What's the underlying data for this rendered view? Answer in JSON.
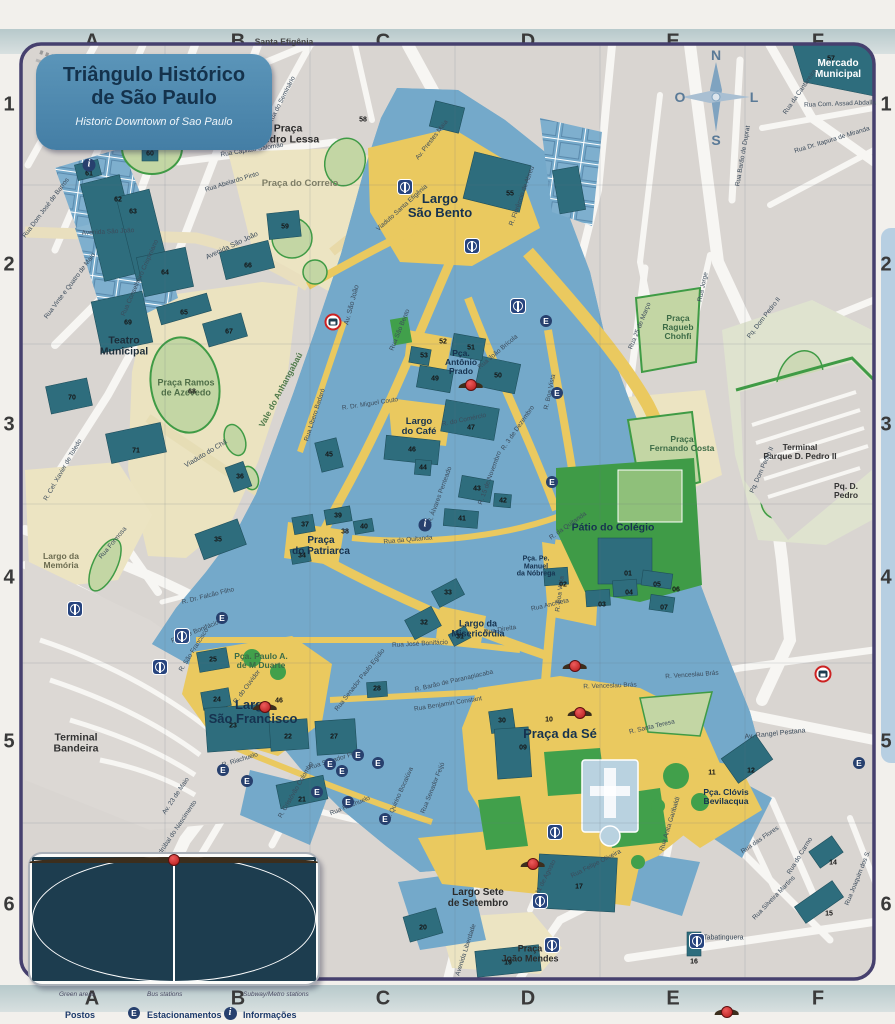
{
  "title": {
    "line1": "Triângulo Histórico",
    "line2": "de São Paulo",
    "subtitle": "Historic Downtown of Sao Paulo"
  },
  "grid": {
    "cols": [
      "A",
      "B",
      "C",
      "D",
      "E",
      "F"
    ],
    "rows": [
      "1",
      "2",
      "3",
      "4",
      "5",
      "6"
    ]
  },
  "compass": {
    "n": "N",
    "s": "S",
    "l": "L",
    "o": "O"
  },
  "legend": {
    "title": "Legenda",
    "items": [
      {
        "label": "Triângulo\nHistórico",
        "sub": "Historic Downtown"
      },
      {
        "label": "Edifícios\nHistóricos",
        "sub": "Historic Sites"
      },
      {
        "label": "Calçadas e\nÁreas de pedestres",
        "sub": "Pedestrian areas"
      },
      {
        "label": "Praças e\ncanteiros",
        "sub": "Green areas"
      },
      {
        "label": "Terminais\nde Ônibus",
        "sub": "Bus stations"
      },
      {
        "label": "Acessos ao Metrô",
        "sub": "Subway/Metro stations"
      },
      {
        "label": "Postos\nPoliciais",
        "sub": "Police"
      },
      {
        "label": "Estacionamentos\nprivativos",
        "sub": "Private parkinglot"
      },
      {
        "label": "Informações\nTurísticas",
        "sub": "Touristic Information"
      }
    ]
  },
  "colors": {
    "triangle": "#6fa8cc",
    "historic": "#2e6d7d",
    "pedestrian": "#eac95f",
    "green": "#3da045"
  },
  "icons": {
    "parking_glyph": "E",
    "info_glyph": "i"
  },
  "places": {
    "largo_sao_bento": "Largo\nSão Bento",
    "praca_da_se": "Praça da Sé",
    "largo_sao_francisco": "Largo\nSão Francisco",
    "patio_do_colegio": "Pátio do Colégio",
    "teatro_municipal": "Teatro\nMunicipal",
    "terminal_bandeira": "Terminal\nBandeira",
    "terminal_parque": "Terminal\nParque D. Pedro II",
    "pq_d_pedro": "Pq. D. Pedro",
    "mercado_municipal": "Mercado\nMunicipal",
    "praca_pedro_lessa": "Praça\nPedro Lessa",
    "praca_do_correio": "Praça do Correio",
    "santa_efigenia": "Santa Efigênia",
    "largo_do_paissandu": "Largo\ndo Paissandu",
    "praca_ramos": "Praça Ramos\nde Azevedo",
    "praca_fernando_costa": "Praça\nFernando Costa",
    "praca_ragueb": "Praça\nRagueb\nChohfi",
    "pca_clovis": "Pça. Clóvis\nBevilacqua",
    "largo_sete": "Largo Sete\nde Setembro",
    "praca_joao_mendes": "Praça\nJoão Mendes",
    "largo_da_memoria": "Largo da\nMemória",
    "largo_misericordia": "Largo da\nMisericórdia",
    "largo_do_cafe": "Largo\ndo Café",
    "pca_antonio_prado": "Pça.\nAntônio\nPrado",
    "praca_do_patriarca": "Praça\ndo Patriarca",
    "pca_paulo_duarte": "Pça. Paulo A.\nde M Duarte",
    "vale_anhangabau": "Vale do Anhangabaú",
    "pca_manuel": "Pça. Pe.\nManuel\nda Nóbrega"
  },
  "streets": {
    "av_sao_joao": "Av. São João",
    "avenida_sao_joao": "Avenida São João",
    "avenida_sao_joao2": "Avenida São João",
    "libero_badaro": "Rua Líbero Badaró",
    "sao_bento": "Rua São Bento",
    "falcao_filho": "R. Dr. Falcão Filho",
    "jose_bonifacio": "R. José Bonifácio",
    "jose_bonifacio2": "Rua José Bonifácio",
    "benjamin": "Rua Benjamin Constant",
    "senador_feijo": "Rua Senador Feijó",
    "senador_feijo2": "Rua Senador Feijó",
    "riachuelo": "R. Riachuelo",
    "riachuelo2": "Rua Riachuelo",
    "direita": "Rua Direita",
    "quitanda": "Rua da Quitanda",
    "quitanda2": "R. da Quitanda",
    "comercio": "R. do Comércio",
    "tres_dezembro": "R. 3 de Dezembro",
    "quinze_novembro": "R. 15 de Novembro",
    "alvares_penteado": "R. Álvares Penteado",
    "boa_vista": "R. Boa Vista",
    "boa_vista2": "R. Boa Vista",
    "florencio": "R. Florêncio de Abreu",
    "prestes_maia": "Av. Prestes Maia",
    "viaduto_sta_efigenia": "Viaduto Santa Efigênia",
    "capitao_salomao": "Rua Capitão Salomão",
    "seminario": "Rua do Seminário",
    "vinte_cinco_marco": "Rua 25 de Março",
    "jorge": "Rua Jorge",
    "pq_dom_pedro": "Pq. Dom Pedro II",
    "pq_dom_pedro2": "Pq. Dom Pedro II",
    "assad_abdalla": "Rua Com. Assad Abdalla",
    "cantareira": "Rua da Cantareira",
    "barao_duprat": "Rua Barão de Duprat",
    "itapura": "Rua Dr. Itapura de Miranda",
    "rangel_pestana": "Av. Rangel Pestana",
    "venceslau": "R. Venceslau Brás",
    "venceslau2": "R. Venceslau Brás",
    "santa_teresa": "R. Santa Teresa",
    "anita_garibaldi": "Rua Anita Garibaldi",
    "carmo": "Rua do Carmo",
    "flores": "Rua das Flores",
    "silveira_martins": "Rua Silveira Martins",
    "joaquim_santos": "Rua Joaquim dos S.",
    "tabatinguera": "Rua Tabatinguera",
    "felipe_oliveira": "Rua Felipe Oliveira",
    "onze_agosto": "11 de Agosto",
    "liberdade": "Avenida Liberdade",
    "barao_paranapiacaba": "R. Barão de Paranapiacaba",
    "quirino_bocaiuva": "R. Quirino Bocaiúva",
    "paulo_egidio": "Rua Senador Paulo Egídio",
    "joao_bricola": "Rua João Brícola",
    "formosa": "Rua Formosa",
    "viaduto_cha": "Viaduto do Chá",
    "xavier_toledo": "R. Cel. Xavier de Toledo",
    "crispiniano": "Rua Conselheiro Crispiniano",
    "dom_jose_barros": "Rua Dom José de Barros",
    "vinte_quatro_maio": "Rua Vinte e Quatro de Maio",
    "abelardo_pinto": "Rua Abelardo Pinto",
    "vinte_tres_maio": "Av. 23 de Maio",
    "asdrubal": "Rua Asdrúbal do Nascimento",
    "cristovao": "R. Cristóvão Colombo",
    "anchieta": "Rua Anchieta",
    "miguel_couto": "R. Dr. Miguel Couto",
    "ouvidor": "R. do Ouvidor",
    "sao_francisco_st": "R. São Francisco"
  },
  "numbers": {
    "n01": "01",
    "n02": "02",
    "n03": "03",
    "n04": "04",
    "n05": "05",
    "n06": "06",
    "n07": "07",
    "n09": "09",
    "n10": "10",
    "n11": "11",
    "n12": "12",
    "n14": "14",
    "n15": "15",
    "n16": "16",
    "n17": "17",
    "n19": "19",
    "n20": "20",
    "n21": "21",
    "n22": "22",
    "n23": "23",
    "n24": "24",
    "n25": "25",
    "n27": "27",
    "n28": "28",
    "n30": "30",
    "n31": "31",
    "n32": "32",
    "n33": "33",
    "n34": "34",
    "n35": "35",
    "n36": "36",
    "n37": "37",
    "n38": "38",
    "n39": "39",
    "n40": "40",
    "n41": "41",
    "n42": "42",
    "n43": "43",
    "n44": "44",
    "n45": "45",
    "n46": "46",
    "n46b": "46",
    "n47": "47",
    "n49": "49",
    "n50": "50",
    "n51": "51",
    "n52": "52",
    "n53": "53",
    "n55": "55",
    "n57": "57",
    "n58": "58",
    "n59": "59",
    "n60": "60",
    "n61": "61",
    "n62": "62",
    "n63": "63",
    "n64": "64",
    "n65": "65",
    "n66": "66",
    "n67": "67",
    "n68": "68",
    "n69": "69",
    "n70": "70",
    "n71": "71"
  }
}
